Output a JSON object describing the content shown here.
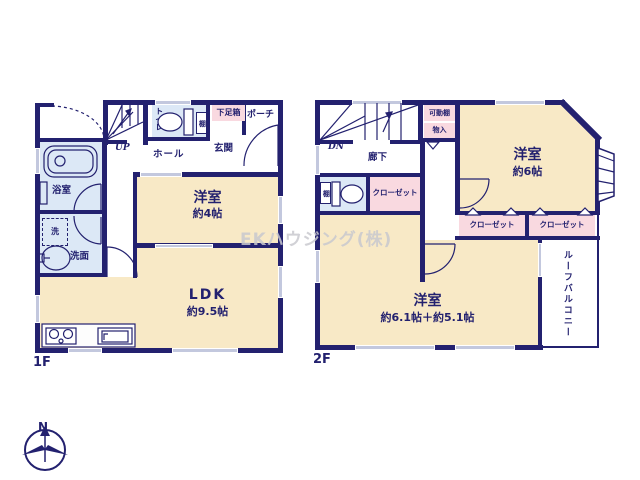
{
  "meta": {
    "watermark": "EKハウジング(株)",
    "compass_n": "N"
  },
  "colors": {
    "wall": "#23216f",
    "tan": "#f8e9c6",
    "pink": "#f9d9e0",
    "blue": "#dce8f6",
    "win": "#c3c8de",
    "ink": "#23216f",
    "wm": "#c9c9cf"
  },
  "f1": {
    "floor_label": "1F",
    "stairs_label": "UP",
    "toilet": "トイレ",
    "toilet_shelf": "棚",
    "shoebox": "下足箱",
    "porch": "ポーチ",
    "genkan": "玄関",
    "hall": "ホール",
    "bath": "浴室",
    "laundry": "洗",
    "washroom": "洗面",
    "room4_name": "洋室",
    "room4_size": "約4帖",
    "ldk_name": "LDK",
    "ldk_size": "約9.5帖"
  },
  "f2": {
    "floor_label": "2F",
    "stairs_label": "DN",
    "corridor": "廊下",
    "movable_shelf": "可動棚",
    "storage": "物入",
    "toilet_shelf": "棚",
    "closet_hall": "クローゼット",
    "closet_a": "クローゼット",
    "closet_b": "クローゼット",
    "room6_name": "洋室",
    "room6_size": "約6帖",
    "room11_name": "洋室",
    "room11_size": "約6.1帖＋約5.1帖",
    "roof_balcony": "ルーフバルコニー"
  }
}
